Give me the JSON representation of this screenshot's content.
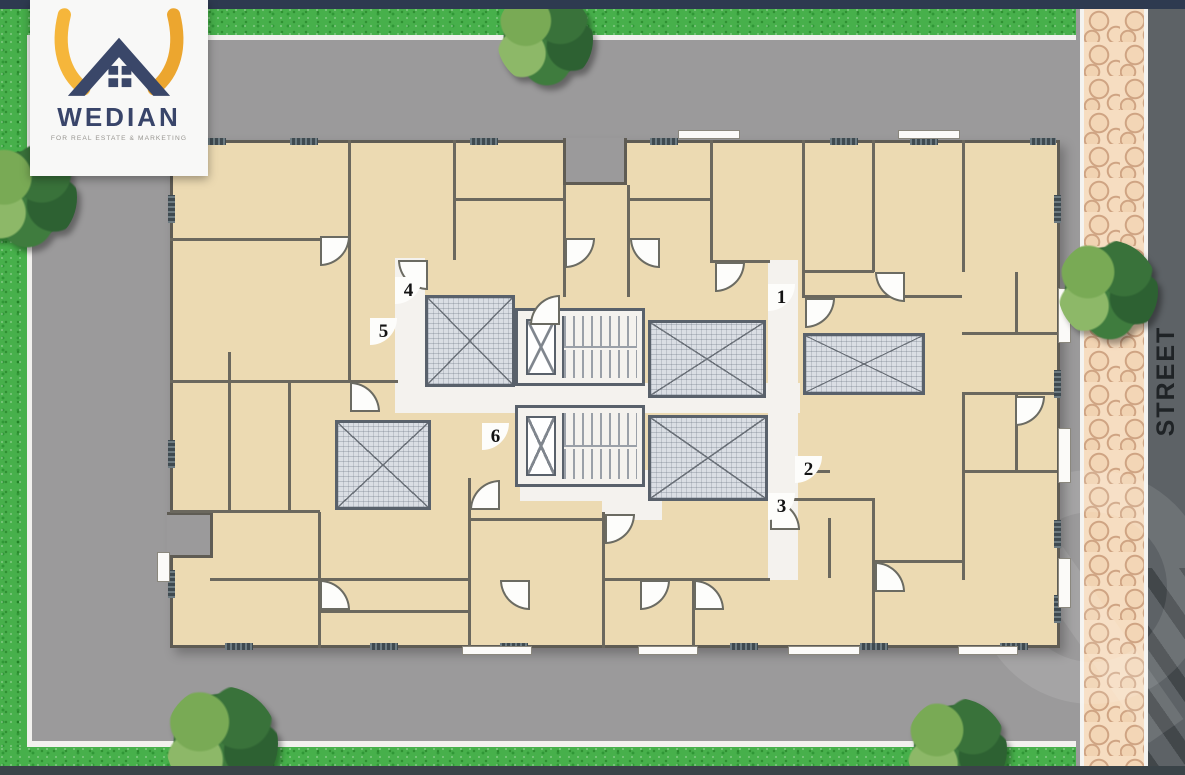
{
  "brand": {
    "name": "WEDIAN",
    "tagline": "FOR REAL ESTATE & MARKETING"
  },
  "street": {
    "label": "STREET"
  },
  "plan": {
    "units": [
      {
        "number": "1",
        "x": 781,
        "y": 297
      },
      {
        "number": "2",
        "x": 808,
        "y": 469
      },
      {
        "number": "3",
        "x": 781,
        "y": 506
      },
      {
        "number": "4",
        "x": 408,
        "y": 290
      },
      {
        "number": "5",
        "x": 383,
        "y": 331
      },
      {
        "number": "6",
        "x": 495,
        "y": 436
      }
    ]
  },
  "site": {
    "trees": [
      {
        "x": 545,
        "y": 38,
        "r": 48
      },
      {
        "x": 25,
        "y": 196,
        "r": 52
      },
      {
        "x": 1108,
        "y": 290,
        "r": 50
      },
      {
        "x": 222,
        "y": 742,
        "r": 56
      },
      {
        "x": 957,
        "y": 748,
        "r": 50
      }
    ]
  },
  "colors": {
    "grass": "#47b04b",
    "ground": "#9b9a9b",
    "street": "#5d6266",
    "sidewalk": "#f6ddc1",
    "room_fill": "#ecdab2",
    "wall": "#6b685e",
    "brand_navy": "#39456a",
    "brand_yellow": "#f5b63b"
  }
}
